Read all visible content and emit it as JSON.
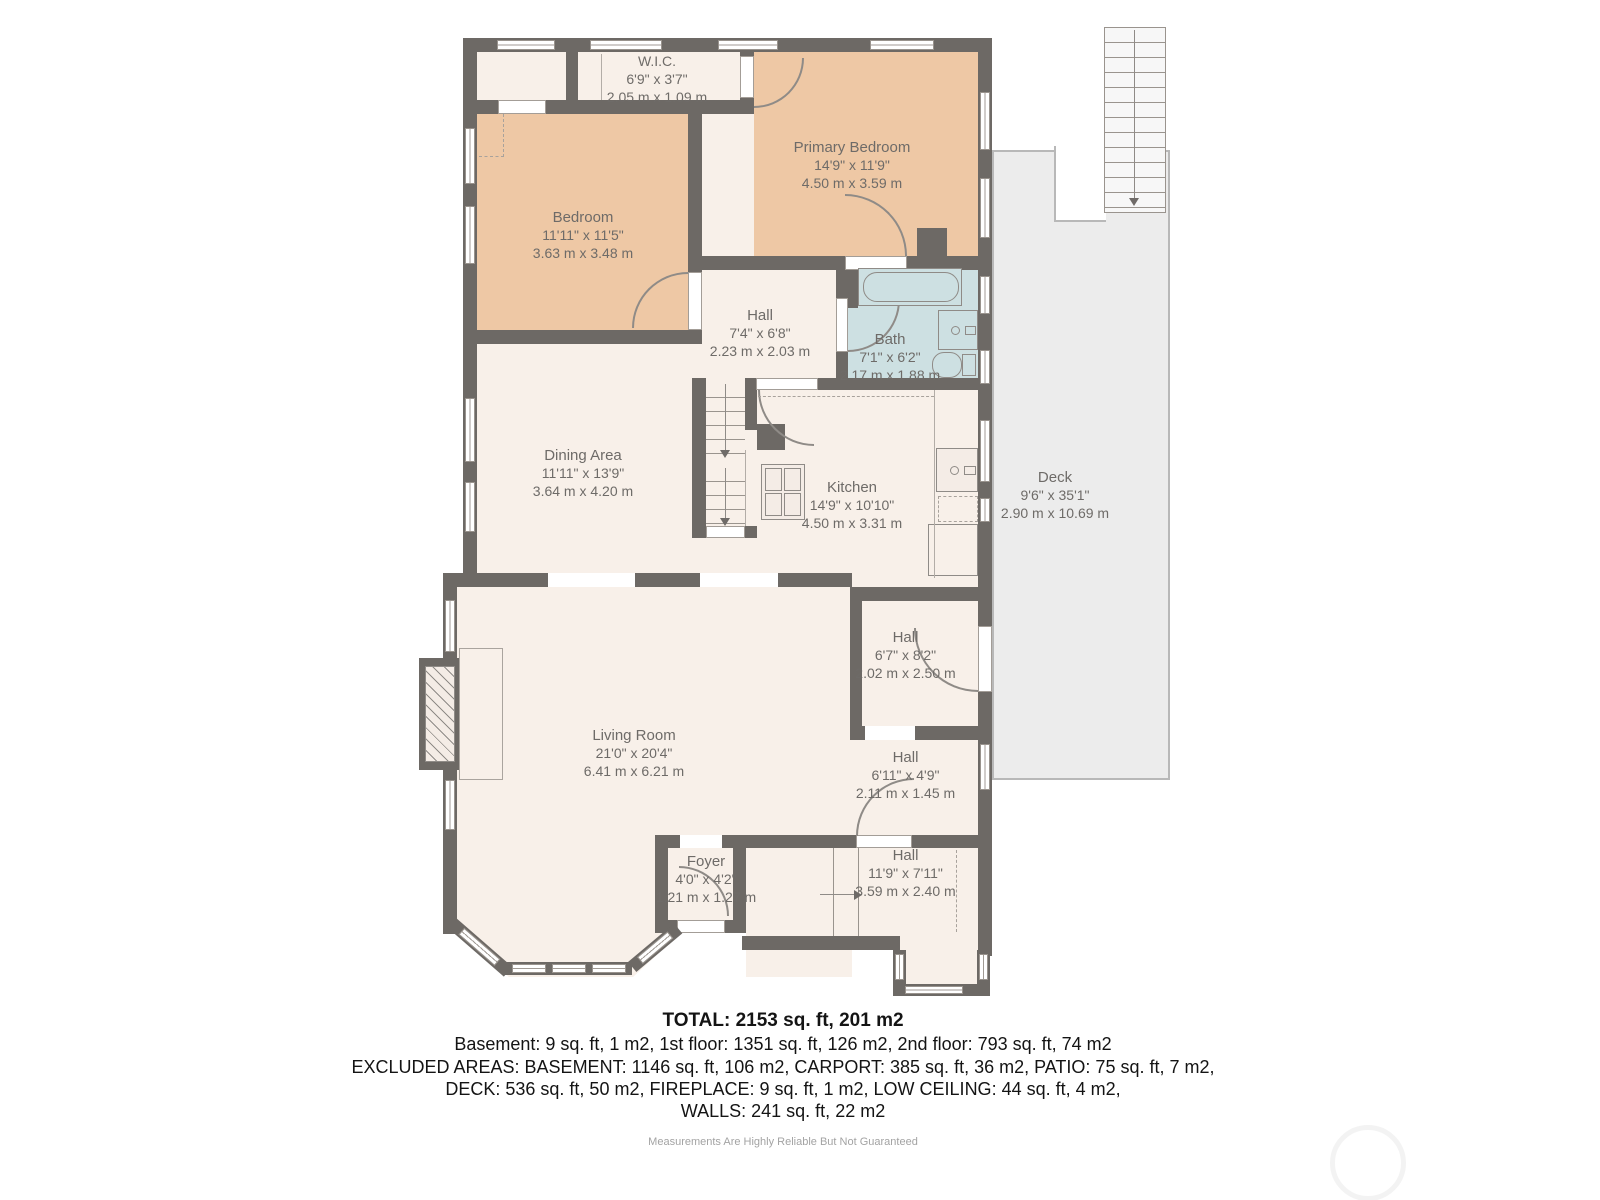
{
  "rooms": [
    {
      "name": "W.I.C.",
      "dims_ft": "6'9\" x 3'7\"",
      "dims_m": "2.05 m x 1.09 m"
    },
    {
      "name": "Primary Bedroom",
      "dims_ft": "14'9\" x 11'9\"",
      "dims_m": "4.50 m x 3.59 m"
    },
    {
      "name": "Bedroom",
      "dims_ft": "11'11\" x 11'5\"",
      "dims_m": "3.63 m x 3.48 m"
    },
    {
      "name": "Hall",
      "dims_ft": "7'4\" x 6'8\"",
      "dims_m": "2.23 m x 2.03 m"
    },
    {
      "name": "Bath",
      "dims_ft": "7'1\" x 6'2\"",
      "dims_m": "2.17 m x 1.88 m"
    },
    {
      "name": "Dining Area",
      "dims_ft": "11'11\" x 13'9\"",
      "dims_m": "3.64 m x 4.20 m"
    },
    {
      "name": "Kitchen",
      "dims_ft": "14'9\" x 10'10\"",
      "dims_m": "4.50 m x 3.31 m"
    },
    {
      "name": "Deck",
      "dims_ft": "9'6\" x 35'1\"",
      "dims_m": "2.90 m x 10.69 m"
    },
    {
      "name": "Hall",
      "dims_ft": "6'7\" x 8'2\"",
      "dims_m": "2.02 m x 2.50 m"
    },
    {
      "name": "Living Room",
      "dims_ft": "21'0\" x 20'4\"",
      "dims_m": "6.41 m x 6.21 m"
    },
    {
      "name": "Hall",
      "dims_ft": "6'11\" x 4'9\"",
      "dims_m": "2.11 m x 1.45 m"
    },
    {
      "name": "Foyer",
      "dims_ft": "4'0\" x 4'2\"",
      "dims_m": "1.21 m x 1.27 m"
    },
    {
      "name": "Hall",
      "dims_ft": "11'9\" x 7'11\"",
      "dims_m": "3.59 m x 2.40 m"
    }
  ],
  "summary": {
    "total": "TOTAL: 2153 sq. ft, 201 m2",
    "line1": "Basement: 9 sq. ft, 1 m2, 1st floor: 1351 sq. ft, 126 m2, 2nd floor: 793 sq. ft, 74 m2",
    "line2": "EXCLUDED AREAS: BASEMENT: 1146 sq. ft, 106 m2, CARPORT: 385 sq. ft, 36 m2, PATIO: 75 sq. ft, 7 m2,",
    "line3": "DECK: 536 sq. ft, 50 m2, FIREPLACE: 9 sq. ft, 1 m2, LOW CEILING: 44 sq. ft, 4 m2,",
    "line4": "WALLS: 241 sq. ft, 22 m2"
  },
  "disclaimer": "Measurements Are Highly Reliable But Not Guaranteed",
  "colors": {
    "wall": "#6d6965",
    "room": "#f8f0e9",
    "bedroom": "#eec8a5",
    "bath": "#cde0e2",
    "deck": "#ececec",
    "label_text": "#6e6b68"
  }
}
